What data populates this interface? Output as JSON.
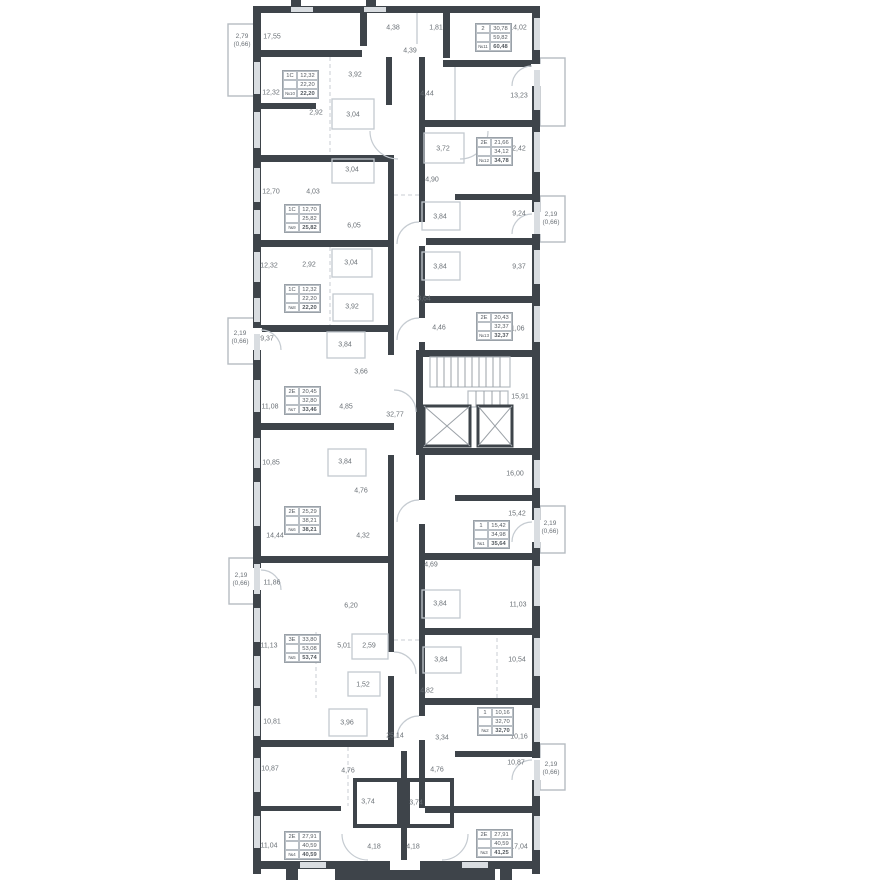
{
  "colors": {
    "wall": "#3e444a",
    "thin_line": "#c3c9cf",
    "window_fill": "#d9dde1",
    "text": "#6a7076",
    "background": "#ffffff"
  },
  "room_labels": [
    "17,55",
    "4,38",
    "1,81",
    "14,02",
    "4,39",
    "3,92",
    "12,32",
    "4,44",
    "13,23",
    "2,92",
    "3,04",
    "3,72",
    "12,42",
    "3,04",
    "12,70",
    "4,03",
    "4,90",
    "6,05",
    "3,84",
    "9,24",
    "12,32",
    "2,92",
    "3,04",
    "3,84",
    "9,37",
    "3,92",
    "3,64",
    "9,37",
    "3,84",
    "4,46",
    "11,06",
    "3,66",
    "11,08",
    "4,85",
    "32,77",
    "15,91",
    "10,85",
    "3,84",
    "16,00",
    "4,76",
    "14,44",
    "4,32",
    "15,42",
    "11,86",
    "4,69",
    "6,20",
    "3,84",
    "11,03",
    "11,13",
    "5,01",
    "2,59",
    "3,84",
    "10,54",
    "1,52",
    "4,82",
    "10,81",
    "3,96",
    "25,14",
    "3,34",
    "10,16",
    "10,87",
    "4,76",
    "4,76",
    "10,87",
    "3,74",
    "3,74",
    "11,04",
    "4,18",
    "4,18",
    "17,04"
  ],
  "balcony_labels": [
    {
      "area": "2,79",
      "coef": "(0,66)"
    },
    {
      "area": "2,19",
      "coef": "(0,66)"
    },
    {
      "area": "2,19",
      "coef": "(0,66)"
    },
    {
      "area": "2,19",
      "coef": "(0,66)"
    },
    {
      "area": "2,19",
      "coef": "(0,66)"
    },
    {
      "area": "2,19",
      "coef": "(0,66)"
    }
  ],
  "apartments": [
    {
      "type": "2",
      "a1": "30,78",
      "a2": "59,82",
      "num": "№11",
      "total": "60,48"
    },
    {
      "type": "1С",
      "a1": "12,32",
      "a2": "22,20",
      "num": "№10",
      "total": "22,20"
    },
    {
      "type": "2Е",
      "a1": "21,66",
      "a2": "34,12",
      "num": "№12",
      "total": "34,78"
    },
    {
      "type": "1С",
      "a1": "12,70",
      "a2": "25,82",
      "num": "№9",
      "total": "25,82"
    },
    {
      "type": "1С",
      "a1": "12,32",
      "a2": "22,20",
      "num": "№8",
      "total": "22,20"
    },
    {
      "type": "2Е",
      "a1": "20,43",
      "a2": "32,37",
      "num": "№13",
      "total": "32,37"
    },
    {
      "type": "2Е",
      "a1": "20,45",
      "a2": "32,80",
      "num": "№7",
      "total": "33,46"
    },
    {
      "type": "2Е",
      "a1": "25,29",
      "a2": "38,21",
      "num": "№6",
      "total": "38,21"
    },
    {
      "type": "1",
      "a1": "15,42",
      "a2": "34,98",
      "num": "№1",
      "total": "35,64"
    },
    {
      "type": "3Е",
      "a1": "33,80",
      "a2": "53,08",
      "num": "№5",
      "total": "53,74"
    },
    {
      "type": "1",
      "a1": "10,16",
      "a2": "32,70",
      "num": "№2",
      "total": "32,70"
    },
    {
      "type": "2Е",
      "a1": "27,91",
      "a2": "40,59",
      "num": "№4",
      "total": "40,59"
    },
    {
      "type": "2Е",
      "a1": "27,91",
      "a2": "40,59",
      "num": "№3",
      "total": "41,25"
    }
  ]
}
